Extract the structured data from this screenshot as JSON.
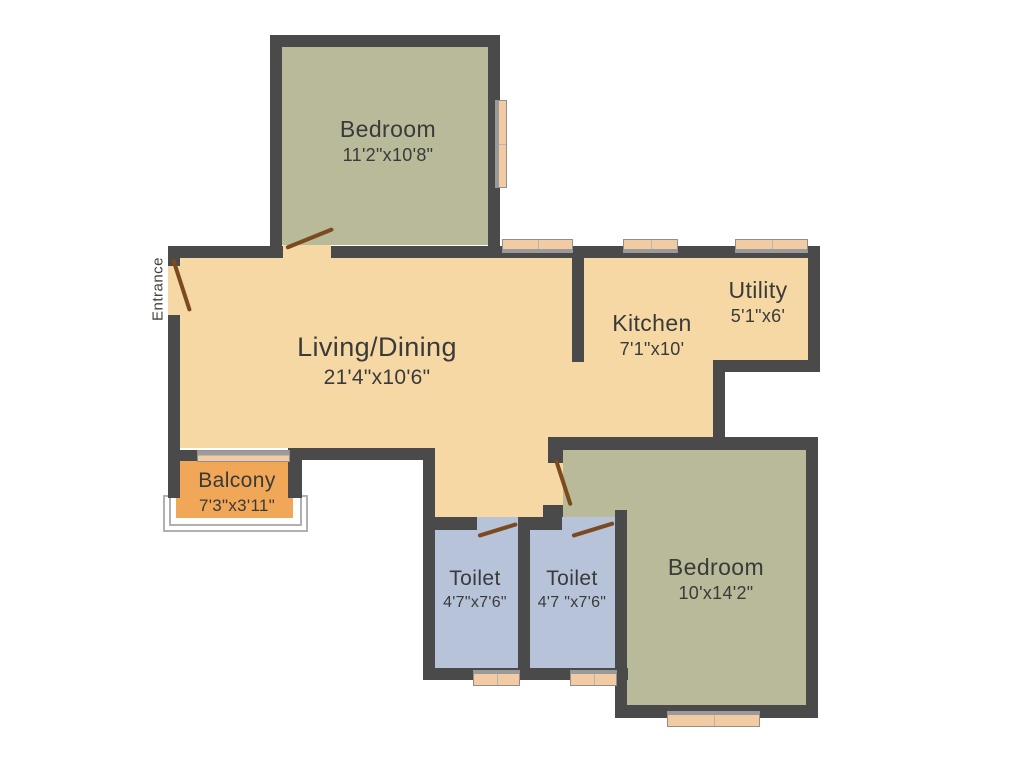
{
  "plan": {
    "entrance_label": "Entrance",
    "rooms": [
      {
        "id": "bedroom-1",
        "name": "Bedroom",
        "dims": "11'2\"x10'8\"",
        "floor_color": "#b8ba99"
      },
      {
        "id": "living-dining",
        "name": "Living/Dining",
        "dims": "21'4\"x10'6\"",
        "floor_color": "#f5d8a4"
      },
      {
        "id": "kitchen",
        "name": "Kitchen",
        "dims": "7'1\"x10'",
        "floor_color": "#f5d8a4"
      },
      {
        "id": "utility",
        "name": "Utility",
        "dims": "5'1\"x6'",
        "floor_color": "#f5d8a4"
      },
      {
        "id": "balcony",
        "name": "Balcony",
        "dims": "7'3\"x3'11\"",
        "floor_color": "#f0a757"
      },
      {
        "id": "toilet-1",
        "name": "Toilet",
        "dims": "4'7\"x7'6\"",
        "floor_color": "#b6c3d9"
      },
      {
        "id": "toilet-2",
        "name": "Toilet",
        "dims": "4'7 \"x7'6\"",
        "floor_color": "#b6c3d9"
      },
      {
        "id": "bedroom-2",
        "name": "Bedroom",
        "dims": "10'x14'2\"",
        "floor_color": "#b8ba99"
      }
    ],
    "palette": {
      "wall": "#4a4a4b",
      "door": "#7b4a1f",
      "window": "#f2cba3",
      "railing": "#b0b0b0",
      "text": "#3a3a3a",
      "background": "#ffffff"
    }
  }
}
